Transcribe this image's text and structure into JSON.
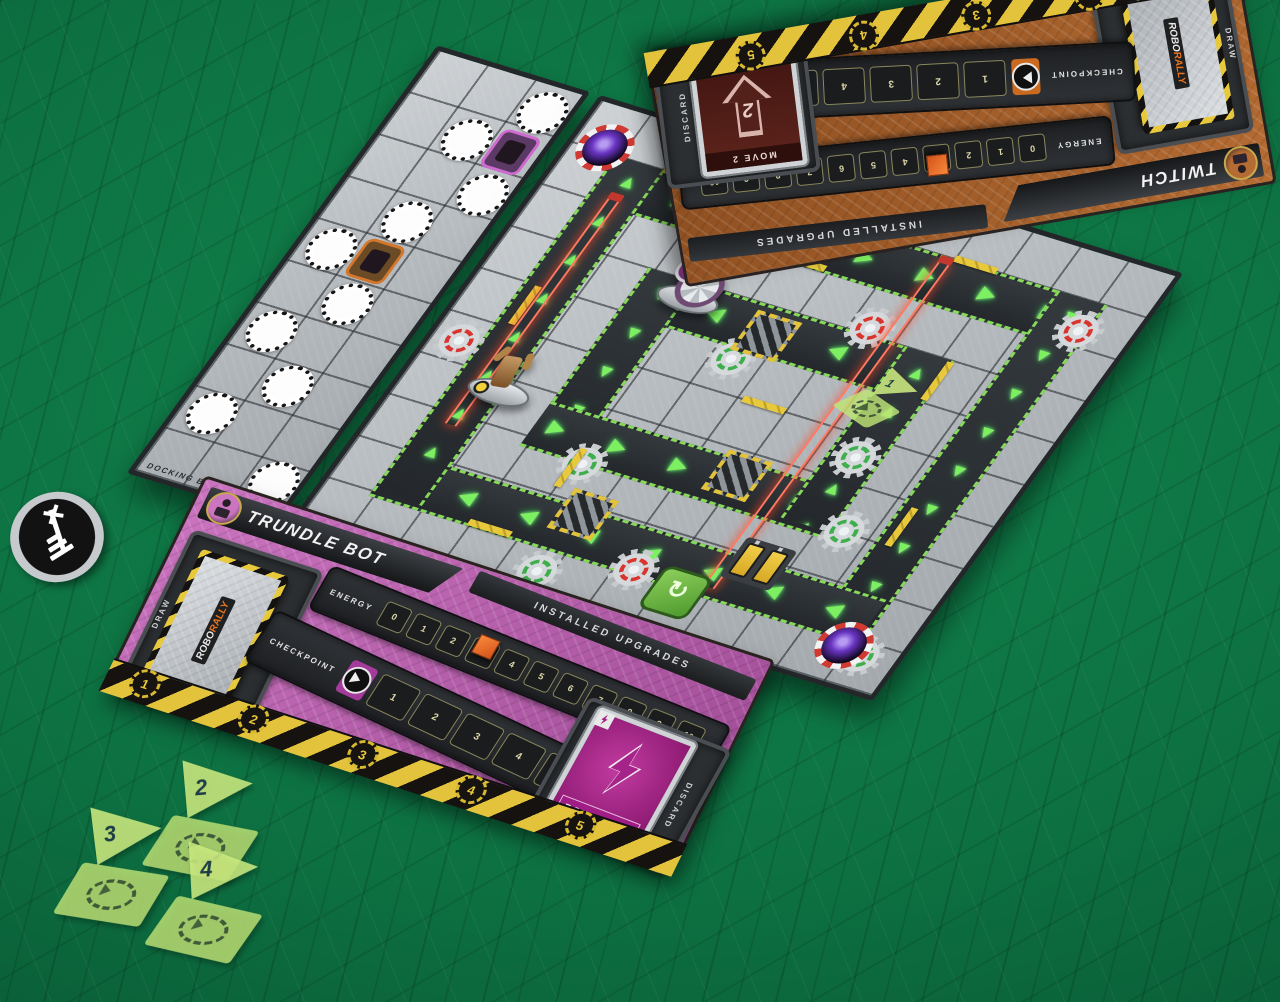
{
  "background": {
    "color": "#0d6e3f"
  },
  "board": {
    "edge_label": "CONCENTRIC",
    "dock": {
      "edge_label": "DOCKING BAY B",
      "start_circles": [
        {
          "x": 104,
          "y": 6
        },
        {
          "x": 56,
          "y": 54
        },
        {
          "x": 104,
          "y": 102
        },
        {
          "x": 56,
          "y": 150
        },
        {
          "x": 8,
          "y": 198
        },
        {
          "x": 56,
          "y": 246
        },
        {
          "x": 8,
          "y": 294
        },
        {
          "x": 56,
          "y": 342
        },
        {
          "x": 8,
          "y": 390
        },
        {
          "x": 104,
          "y": 438
        }
      ],
      "tokens": [
        {
          "x": 104,
          "y": 54,
          "kind": "purple-bot"
        },
        {
          "x": 56,
          "y": 198,
          "kind": "orange-bot"
        }
      ]
    },
    "gears": [
      {
        "x": 112,
        "y": 6,
        "c": "red"
      },
      {
        "x": 348,
        "y": 116,
        "c": "red"
      },
      {
        "x": 528,
        "y": 58,
        "c": "red"
      },
      {
        "x": 4,
        "y": 248,
        "c": "red"
      },
      {
        "x": 296,
        "y": 416,
        "c": "red"
      },
      {
        "x": 248,
        "y": 186,
        "c": "green"
      },
      {
        "x": 452,
        "y": 318,
        "c": "green"
      },
      {
        "x": 542,
        "y": 432,
        "c": "green"
      },
      {
        "x": 214,
        "y": 446,
        "c": "green"
      },
      {
        "x": 416,
        "y": 244,
        "c": "green"
      },
      {
        "x": 186,
        "y": 330,
        "c": "green"
      }
    ],
    "lasers": [
      {
        "x": 66,
        "y": 92,
        "len": 262
      },
      {
        "x": 388,
        "y": 56,
        "len": 378
      }
    ],
    "crushers": [
      {
        "x": 264,
        "y": 154
      },
      {
        "x": 326,
        "y": 296
      },
      {
        "x": 218,
        "y": 378
      }
    ],
    "black_holes": [
      {
        "x": 6,
        "y": 18
      },
      {
        "x": 520,
        "y": 424
      }
    ],
    "reboot_token": {
      "x": 344,
      "y": 424
    },
    "battery_tile": {
      "x": 396,
      "y": 374
    },
    "walls": [
      {
        "x": 96,
        "y": 44,
        "o": "h"
      },
      {
        "x": 252,
        "y": 92,
        "o": "h"
      },
      {
        "x": 198,
        "y": 338,
        "o": "v"
      },
      {
        "x": 458,
        "y": 148,
        "o": "v"
      },
      {
        "x": 306,
        "y": 240,
        "o": "h"
      },
      {
        "x": 518,
        "y": 298,
        "o": "v"
      },
      {
        "x": 148,
        "y": 438,
        "o": "h"
      },
      {
        "x": 58,
        "y": 196,
        "o": "v"
      },
      {
        "x": 400,
        "y": 44,
        "o": "h"
      }
    ],
    "checkpoint_token": {
      "x": 392,
      "y": 170,
      "label": "1"
    },
    "robots": [
      {
        "x": 164,
        "y": 118,
        "kind": "trundle"
      },
      {
        "x": 60,
        "y": 262,
        "kind": "twitch"
      }
    ]
  },
  "twitch_mat": {
    "title": "TWITCH",
    "upgrades_label": "INSTALLED UPGRADES",
    "energy_label": "ENERGY",
    "energy_values": [
      "0",
      "1",
      "2",
      "3",
      "4",
      "5",
      "6",
      "7",
      "8",
      "9",
      "10"
    ],
    "energy_marker": "3",
    "checkpoint_label": "CHECKPOINT",
    "checkpoint_values": [
      "1",
      "2",
      "3",
      "4",
      "5",
      "6"
    ],
    "badges": [
      "1",
      "2",
      "3",
      "4",
      "5"
    ],
    "draw_label": "DRAW",
    "discard_label": "DISCARD",
    "deck_logo_a": "ROBO",
    "deck_logo_b": "RALLY",
    "discard_card": {
      "title": "MOVE 2",
      "value": "2"
    }
  },
  "trundle_mat": {
    "title": "TRUNDLE BOT",
    "upgrades_label": "INSTALLED UPGRADES",
    "energy_label": "ENERGY",
    "energy_values": [
      "0",
      "1",
      "2",
      "3",
      "4",
      "5",
      "6",
      "7",
      "8",
      "9",
      "10"
    ],
    "energy_marker": "3",
    "checkpoint_label": "CHECKPOINT",
    "checkpoint_values": [
      "1",
      "2",
      "3",
      "4",
      "5",
      "6"
    ],
    "badges": [
      "1",
      "2",
      "3",
      "4",
      "5"
    ],
    "draw_label": "DRAW",
    "discard_label": "DISCARD",
    "deck_logo_a": "ROBO",
    "deck_logo_b": "RALLY",
    "discard_card": {
      "title": "POWER UP"
    }
  },
  "table_tokens": {
    "antenna": {
      "x": 10,
      "y": 492
    },
    "flags": [
      {
        "n": "2",
        "x": 148,
        "y": 758,
        "r": -5
      },
      {
        "n": "3",
        "x": 58,
        "y": 804,
        "r": -7
      },
      {
        "n": "4",
        "x": 152,
        "y": 840,
        "r": -3
      }
    ]
  }
}
